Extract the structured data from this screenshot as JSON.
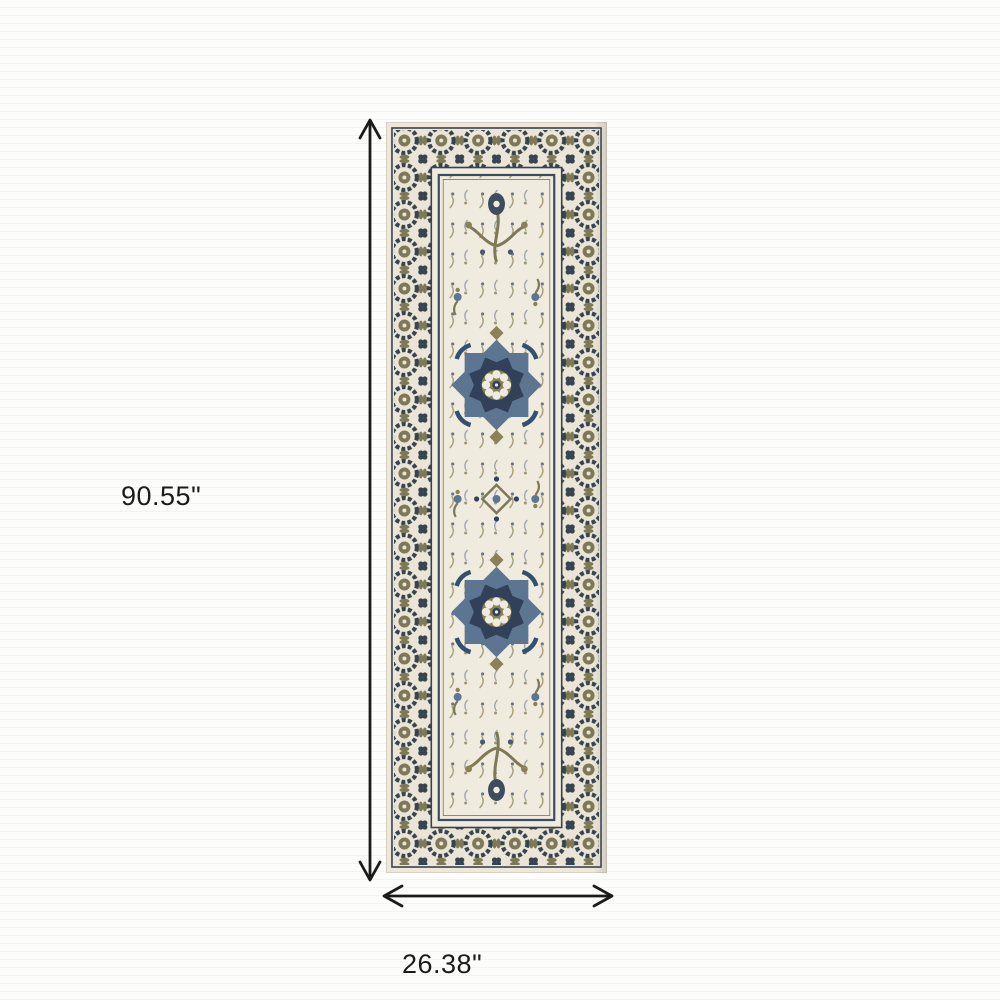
{
  "diagram": {
    "height_label": "90.55\"",
    "width_label": "26.38\"",
    "subject": "ivory navy and olive oriental runner rug",
    "colors": {
      "arrow": "#1b1b1b",
      "label_text": "#1b1b1b",
      "background": "#fdfdfc",
      "background_stripe": "#f3f3f0",
      "rug_ivory": "#EDE8DA",
      "rug_field_ivory": "#EFEBDE",
      "rug_navy": "#32415A",
      "rug_charcoal": "#37434F",
      "rug_steel_blue": "#5C7590",
      "rug_olive": "#7D7856",
      "rug_tan": "#A29366"
    }
  }
}
